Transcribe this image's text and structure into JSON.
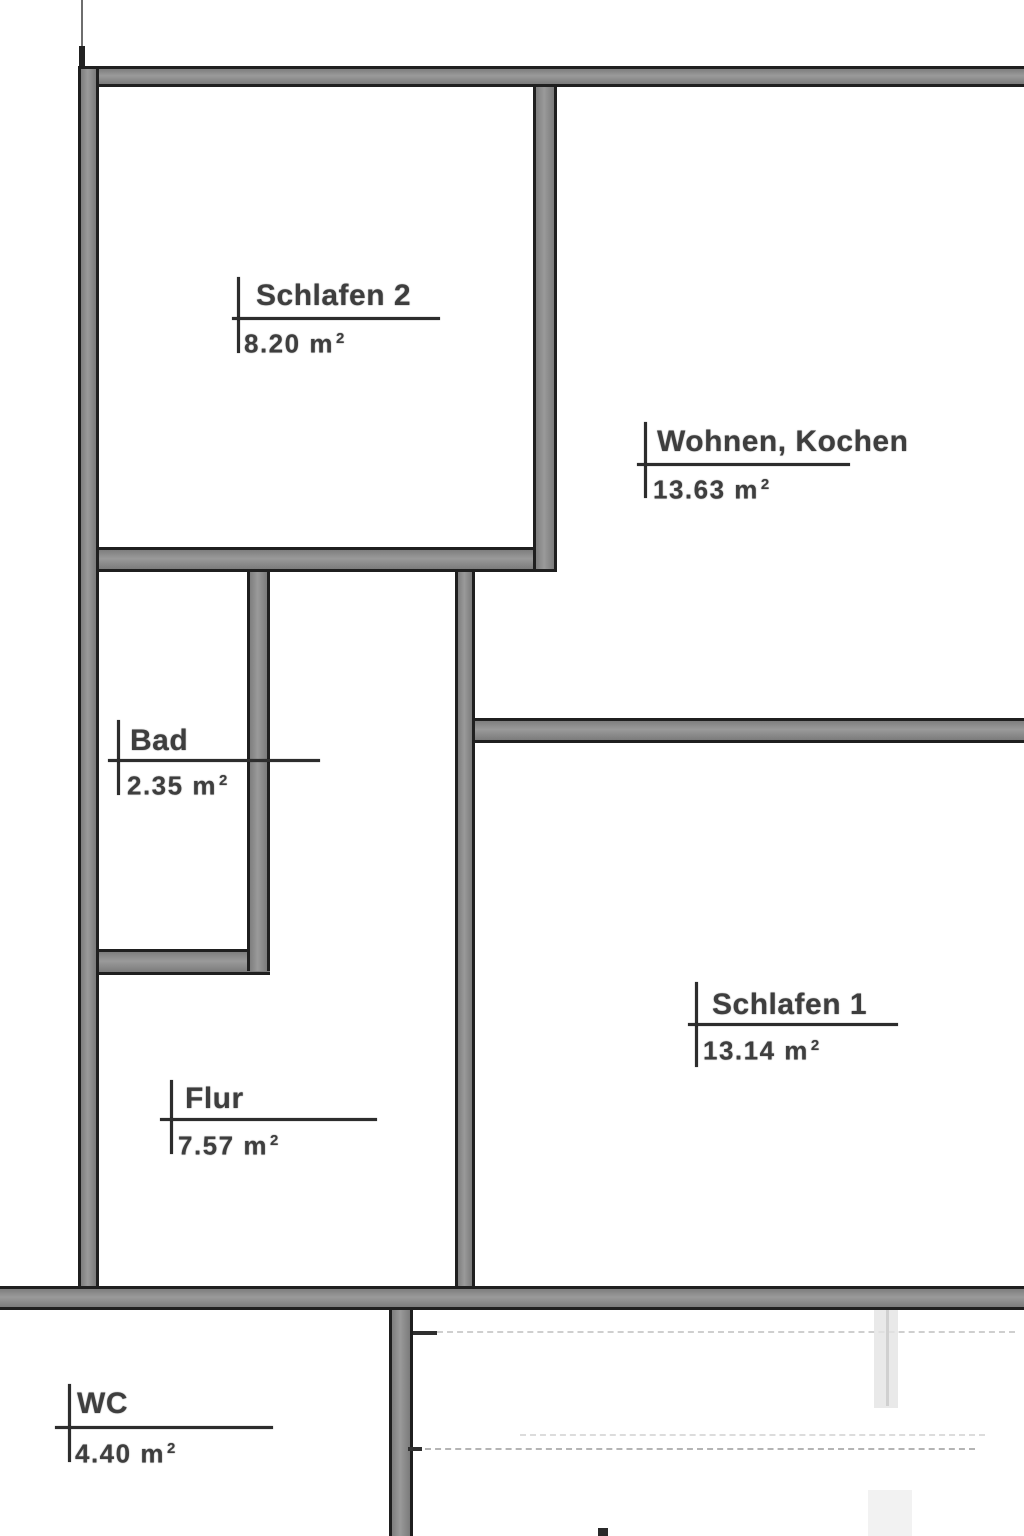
{
  "document": {
    "kind": "floor-plan"
  },
  "rooms": [
    {
      "id": "schlafen-2",
      "name": "Schlafen 2",
      "area": "8.20 m",
      "area_sup": "2"
    },
    {
      "id": "wohnen-kochen",
      "name": "Wohnen, Kochen",
      "area": "13.63 m",
      "area_sup": "2"
    },
    {
      "id": "bad",
      "name": "Bad",
      "area": "2.35 m",
      "area_sup": "2"
    },
    {
      "id": "schlafen-1",
      "name": "Schlafen 1",
      "area": "13.14 m",
      "area_sup": "2"
    },
    {
      "id": "flur",
      "name": "Flur",
      "area": "7.57 m",
      "area_sup": "2"
    },
    {
      "id": "wc",
      "name": "WC",
      "area": "4.40 m",
      "area_sup": "2"
    }
  ],
  "colors": {
    "background": "#ffffff",
    "wall_fill": "#8a8a8a",
    "wall_edge": "#1f1f1f",
    "label_line": "#2d2d2d",
    "label_text": "#3e3e3e"
  }
}
